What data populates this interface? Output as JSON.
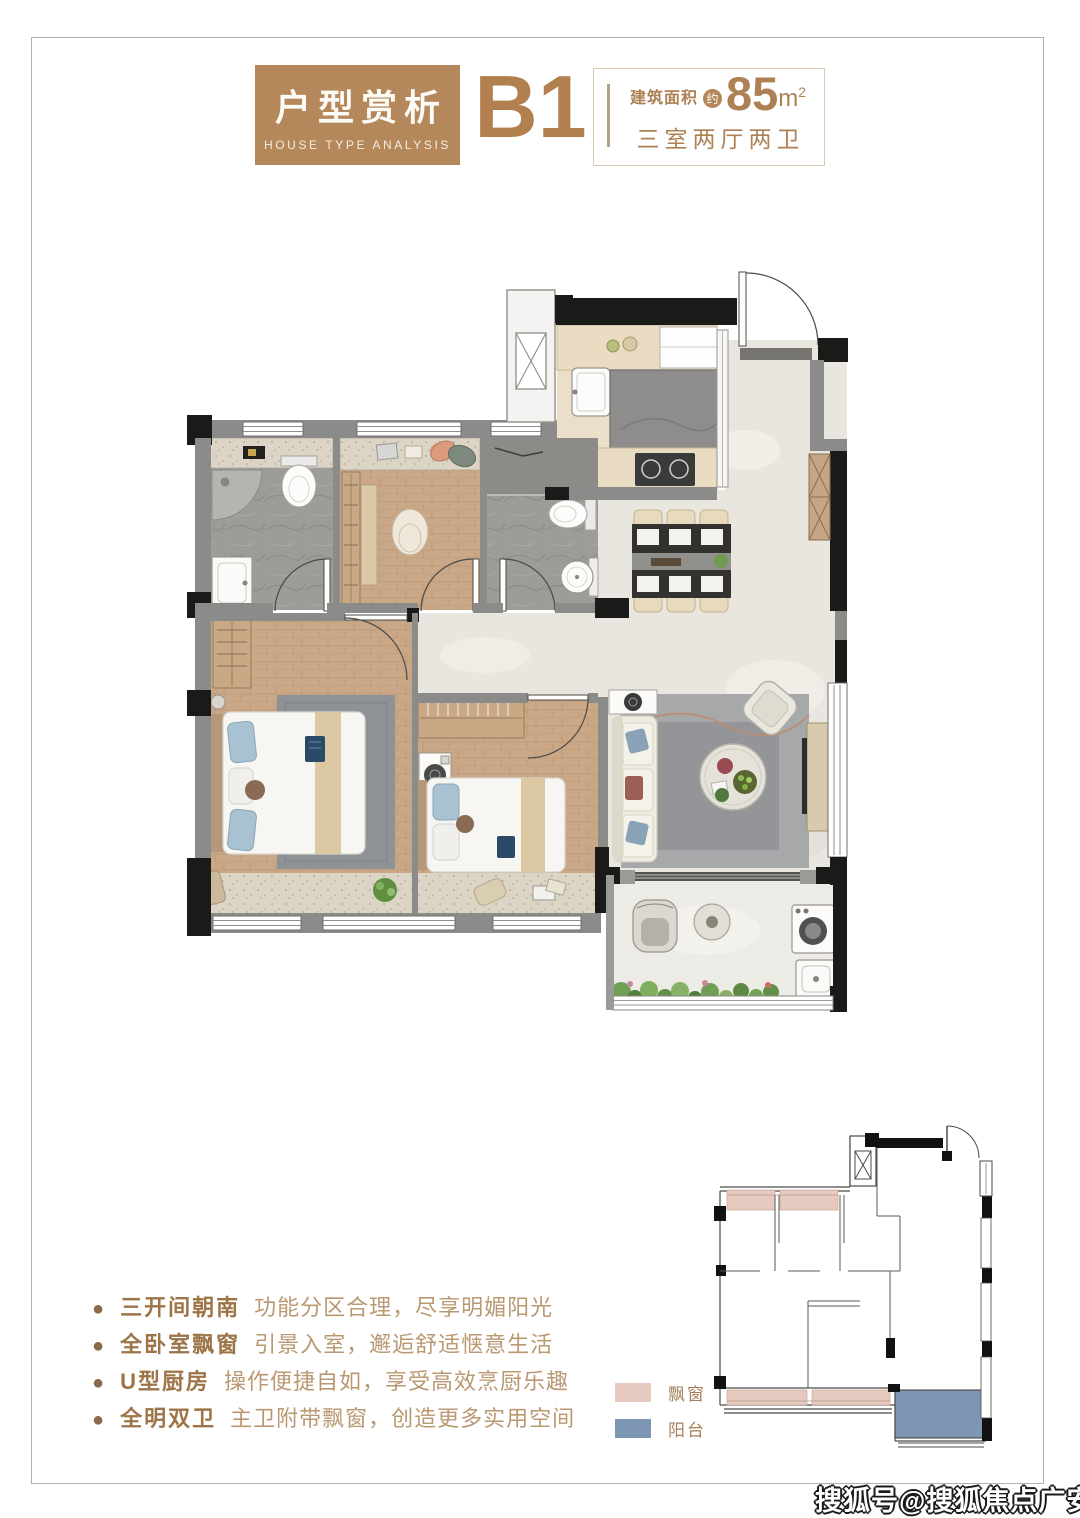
{
  "page": {
    "background": "#ffffff",
    "border_color": "#b3b1ae"
  },
  "header": {
    "badge": {
      "title": "户型赏析",
      "subtitle": "HOUSE TYPE ANALYSIS",
      "bg": "#b5885c"
    },
    "unit": "B1",
    "area": {
      "prefix": "建筑面积",
      "approx": "约",
      "value": "85",
      "unit": "m",
      "sup": "2"
    },
    "layout": "三室两厅两卫",
    "accent": "#ad8153"
  },
  "features": {
    "items": [
      {
        "lead": "三开间朝南",
        "desc": "功能分区合理，尽享明媚阳光"
      },
      {
        "lead": "全卧室飘窗",
        "desc": "引景入室，邂逅舒适惬意生活"
      },
      {
        "lead": "U型厨房",
        "desc": "操作便捷自如，享受高效烹厨乐趣"
      },
      {
        "lead": "全明双卫",
        "desc": "主卫附带飘窗，创造更多实用空间"
      }
    ]
  },
  "legend": {
    "items": [
      {
        "label": "飘窗",
        "color": "#e6c9bf"
      },
      {
        "label": "阳台",
        "color": "#7d96b4"
      }
    ]
  },
  "watermark": "搜狐号@搜狐焦点广安站"
}
